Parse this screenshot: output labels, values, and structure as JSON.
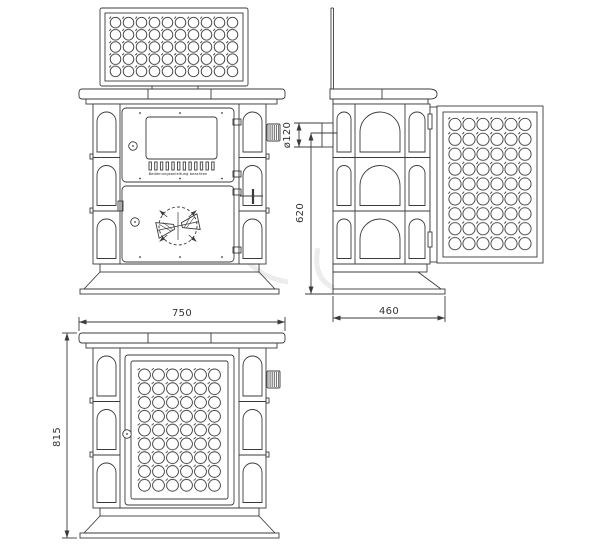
{
  "drawing": {
    "subject": "tiled stove three-view technical drawing",
    "views": {
      "front_open": "front view, top grille panel open",
      "side": "side view, grille door swung open",
      "front_closed": "front view, grille door closed"
    },
    "dimensions": {
      "width": "750",
      "height": "815",
      "depth": "460",
      "flue_diameter": "ø120",
      "flue_center_height": "620"
    },
    "door_label": "Bedienungsanleitung beachten"
  }
}
